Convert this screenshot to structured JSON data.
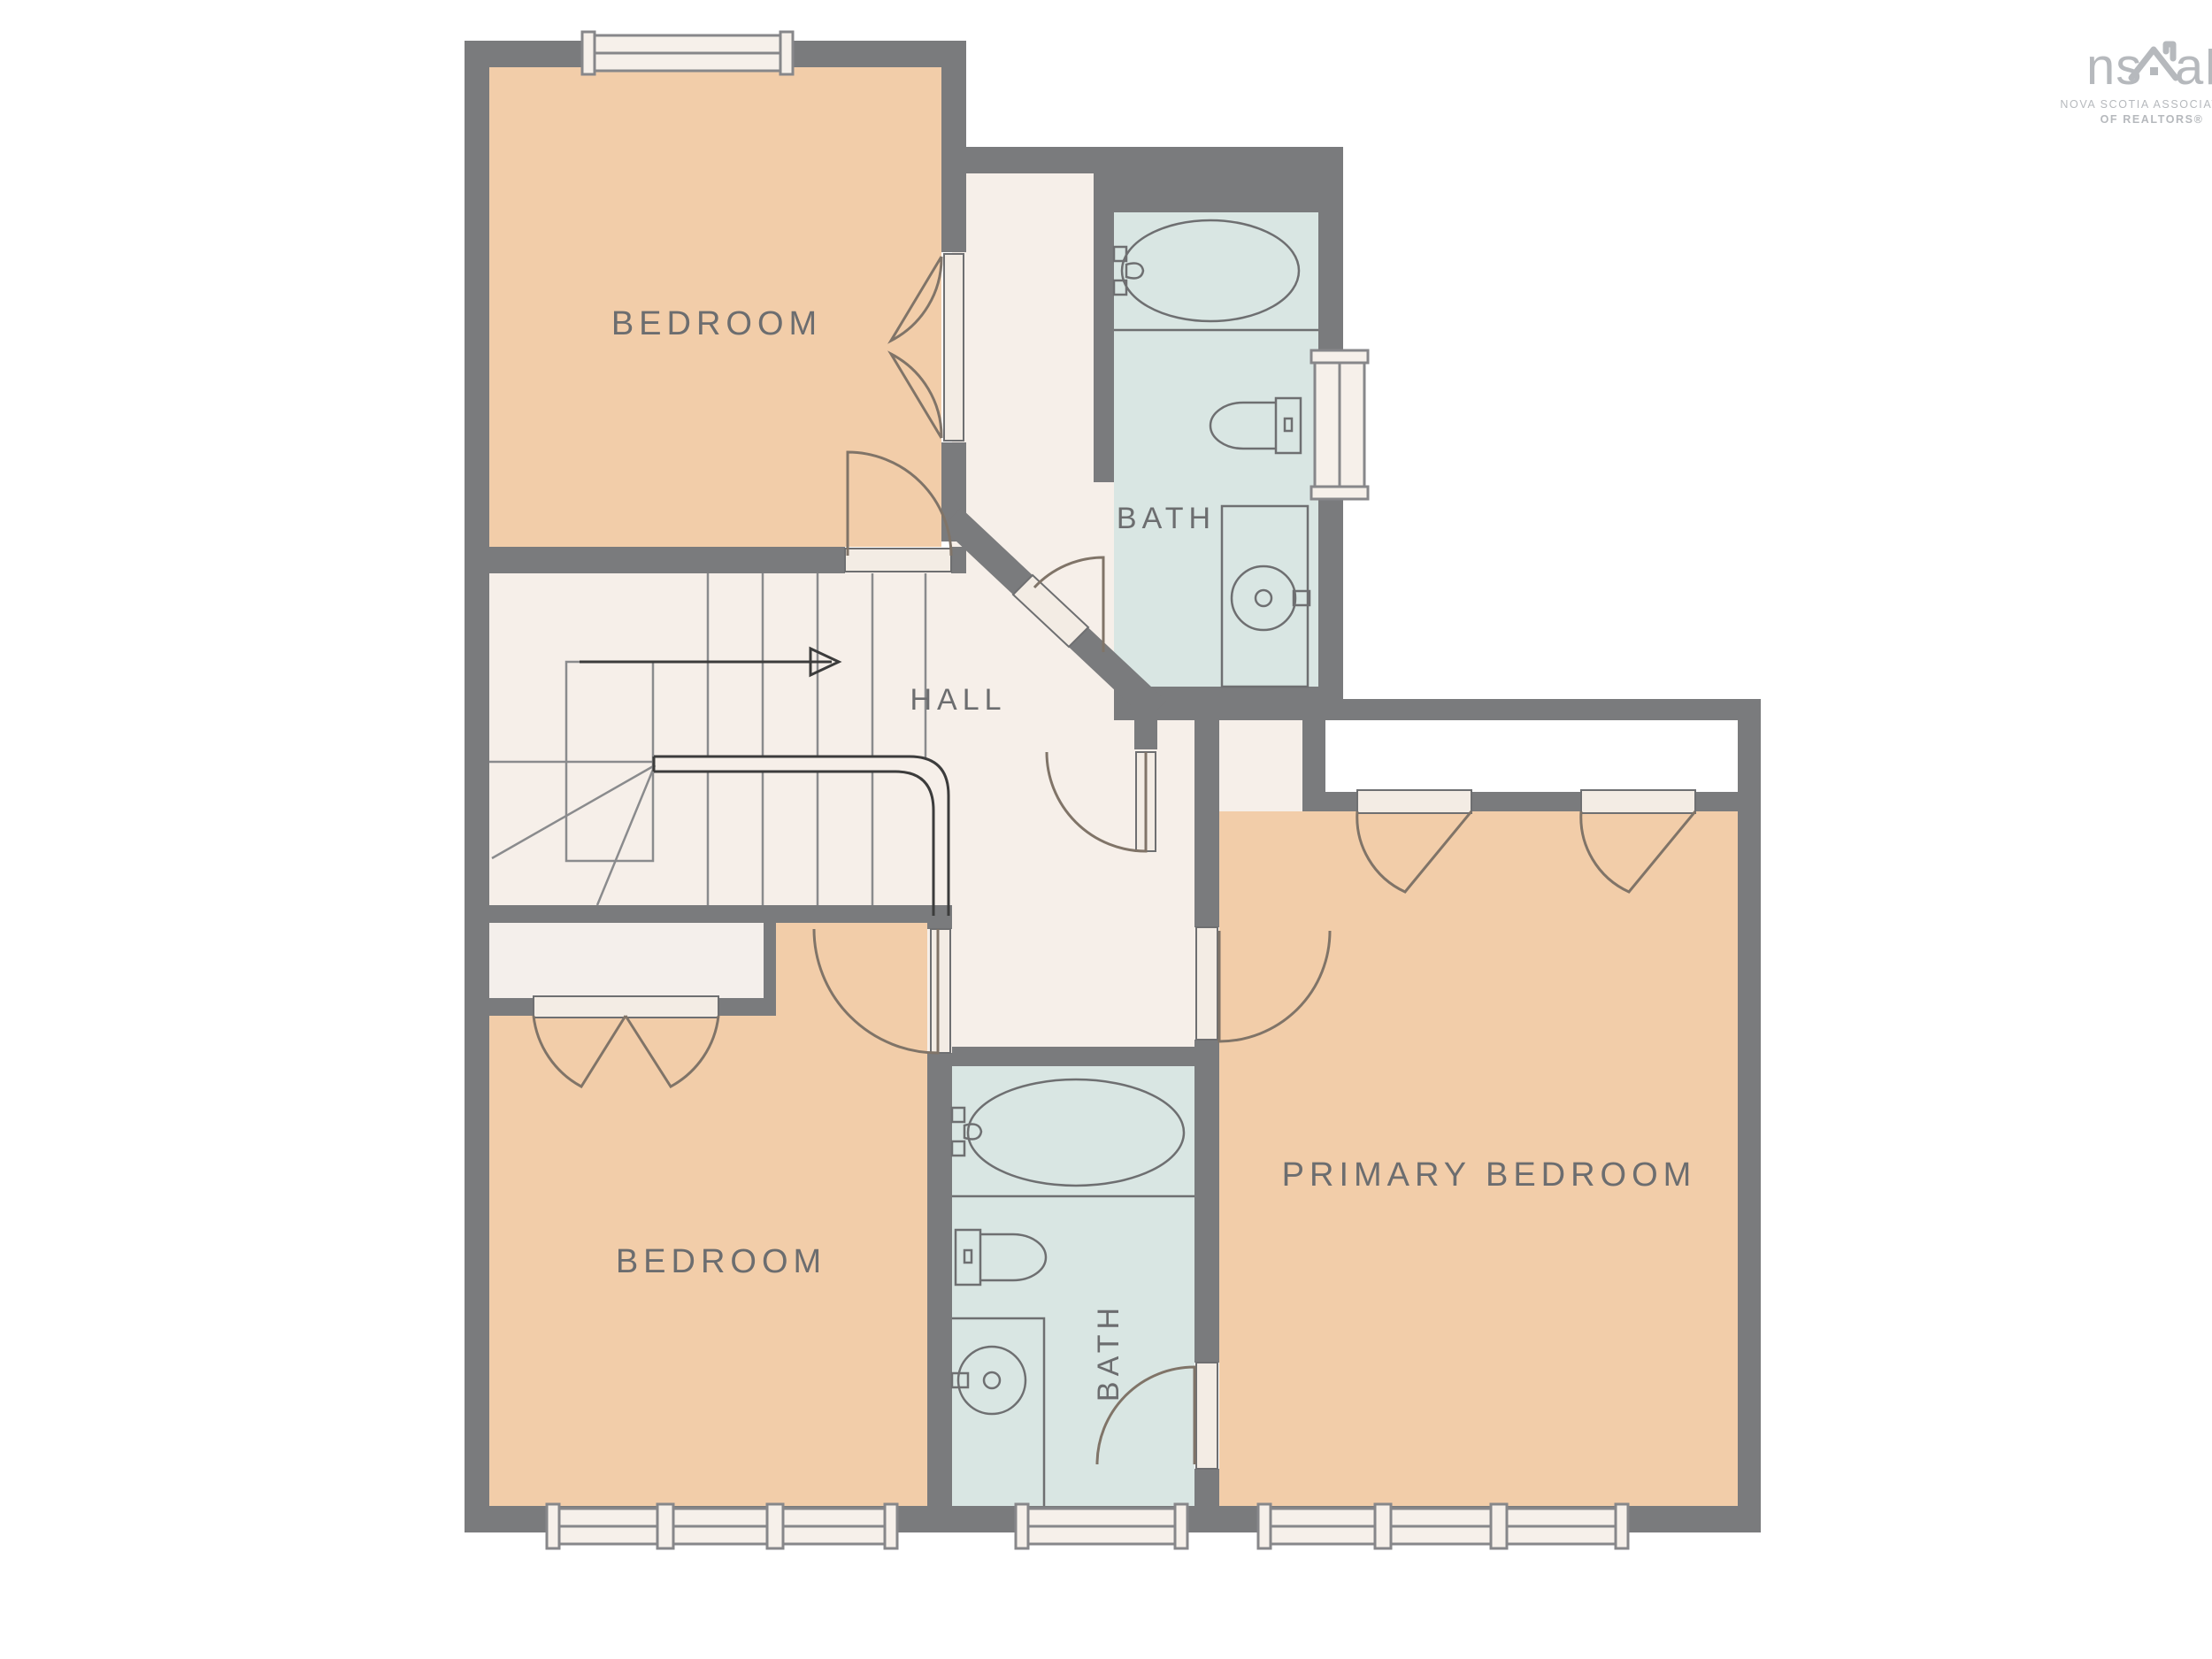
{
  "meta": {
    "type": "residential floor plan (upper storey)",
    "colors": {
      "wall": "#7a7b7d",
      "bedroom_fill": "#f2cda9",
      "bath_fill": "#d9e6e3",
      "hall_fill": "#f6efe9",
      "closet_fill": "#f4efeb",
      "closet_white_fill": "#ffffff",
      "door_slab_fill": "#f3ece4",
      "window_fill": "#f6f0ea",
      "fixture_line": "#6e6f71",
      "label_text": "#6c6d6f",
      "logo_gray": "#b6b9bd",
      "background": "#ffffff"
    }
  },
  "rooms": {
    "bedroom_top": "BEDROOM",
    "bath_top": "BATH",
    "hall": "HALL",
    "bedroom_lower": "BEDROOM",
    "bath_lower": "BATH",
    "primary_bedroom": "PRIMARY BEDROOM"
  },
  "logo": {
    "word_left": "ns",
    "word_right": "aR",
    "subline1": "NOVA SCOTIA ASSOCIATION",
    "subline2": "OF REALTORS®"
  }
}
